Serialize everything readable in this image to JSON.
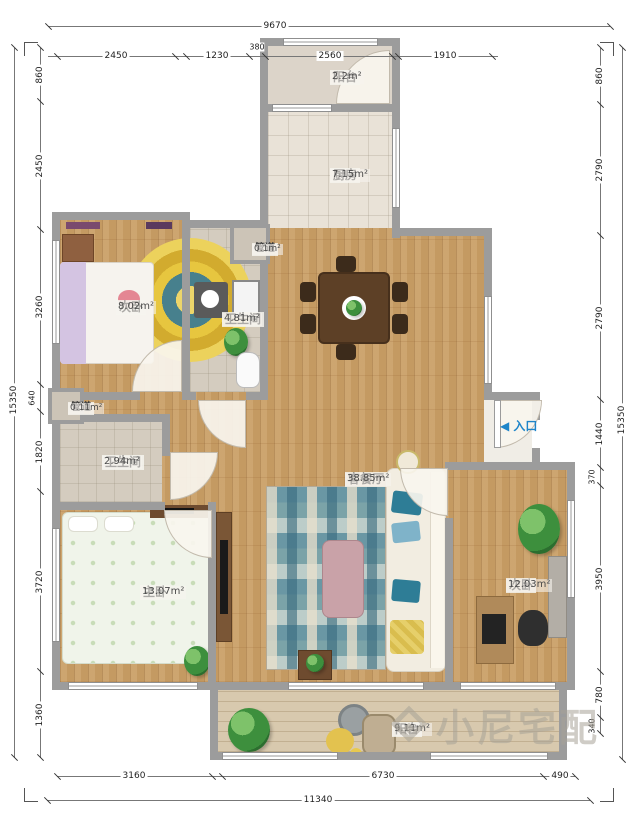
{
  "watermark": {
    "text": "小尼宅配"
  },
  "entrance": {
    "arrow": "◀",
    "label": "入口"
  },
  "rooms": [
    {
      "id": "balcony-top",
      "name": "阳台",
      "area": "2.2m²"
    },
    {
      "id": "kitchen",
      "name": "厨房",
      "area": "7.15m²"
    },
    {
      "id": "duct-top",
      "name": "管道",
      "area": "0.1m²"
    },
    {
      "id": "bedroom-left",
      "name": "次卧",
      "area": "8.02m²"
    },
    {
      "id": "bathroom-top",
      "name": "卫生间",
      "area": "4.81m²"
    },
    {
      "id": "duct-left",
      "name": "管道",
      "area": "0.11m²"
    },
    {
      "id": "bathroom-left",
      "name": "卫生间",
      "area": "2.94m²"
    },
    {
      "id": "master-bedroom",
      "name": "主卧",
      "area": "13.07m²"
    },
    {
      "id": "living-dining",
      "name": "客餐厅",
      "area": "38.85m²"
    },
    {
      "id": "bedroom-right",
      "name": "次卧",
      "area": "12.03m²"
    },
    {
      "id": "balcony-bottom",
      "name": "阳台",
      "area": "9.11m²"
    }
  ],
  "dimensions": {
    "top": {
      "total": "9670",
      "segments": [
        "2450",
        "1230",
        "380",
        "2560",
        "1910"
      ]
    },
    "bottom": {
      "total": "11340",
      "segments": [
        "3160",
        "6730",
        "490"
      ]
    },
    "left": {
      "total": "15350",
      "segments": [
        "860",
        "2450",
        "3260",
        "640",
        "1820",
        "3720",
        "1360"
      ]
    },
    "right": {
      "total": "15350",
      "segments": [
        "860",
        "2790",
        "2790",
        "1440",
        "370",
        "3950",
        "780",
        "340"
      ]
    }
  },
  "colors": {
    "wall": "#9c9c9c",
    "wood": "#c49a62",
    "accent_blue": "#1f85c9"
  }
}
